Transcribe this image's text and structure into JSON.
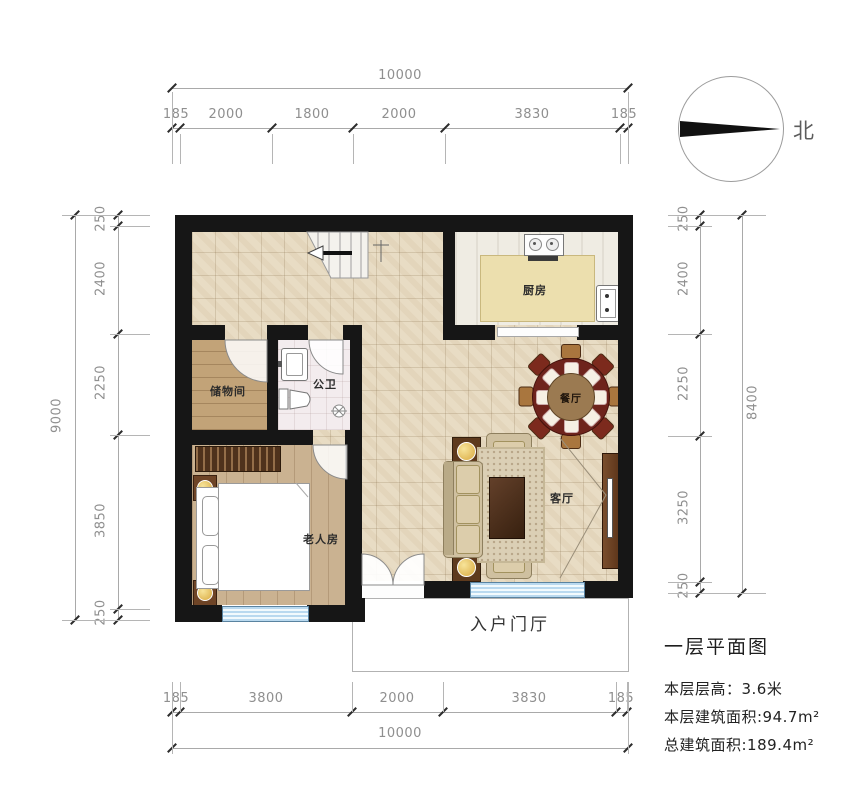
{
  "compass": {
    "label": "北"
  },
  "dimensions": {
    "top": {
      "total": "10000",
      "segments": [
        "185",
        "2000",
        "1800",
        "2000",
        "3830",
        "185"
      ]
    },
    "bottom": {
      "total": "10000",
      "segments": [
        "185",
        "3800",
        "2000",
        "3830",
        "185"
      ]
    },
    "left": {
      "total": "9000",
      "segments": [
        "250",
        "2400",
        "2250",
        "3850",
        "250"
      ]
    },
    "right": {
      "total": "8400",
      "segments": [
        "250",
        "2400",
        "2250",
        "3250",
        "250"
      ]
    }
  },
  "rooms": {
    "storage": "储物间",
    "bathroom": "公卫",
    "bedroom": "老人房",
    "kitchen": "厨房",
    "dining": "餐厅",
    "living": "客厅",
    "foyer": "入户门厅"
  },
  "title_block": {
    "title": "一层平面图",
    "floor_height": "本层层高：3.6米",
    "floor_area": "本层建筑面积:94.7m²",
    "total_area": "总建筑面积:189.4m²"
  },
  "colors": {
    "wall": "#161616",
    "window": "#b9d9ef",
    "dining_table": "#6e241c",
    "dim_text": "#8f8f8f"
  }
}
